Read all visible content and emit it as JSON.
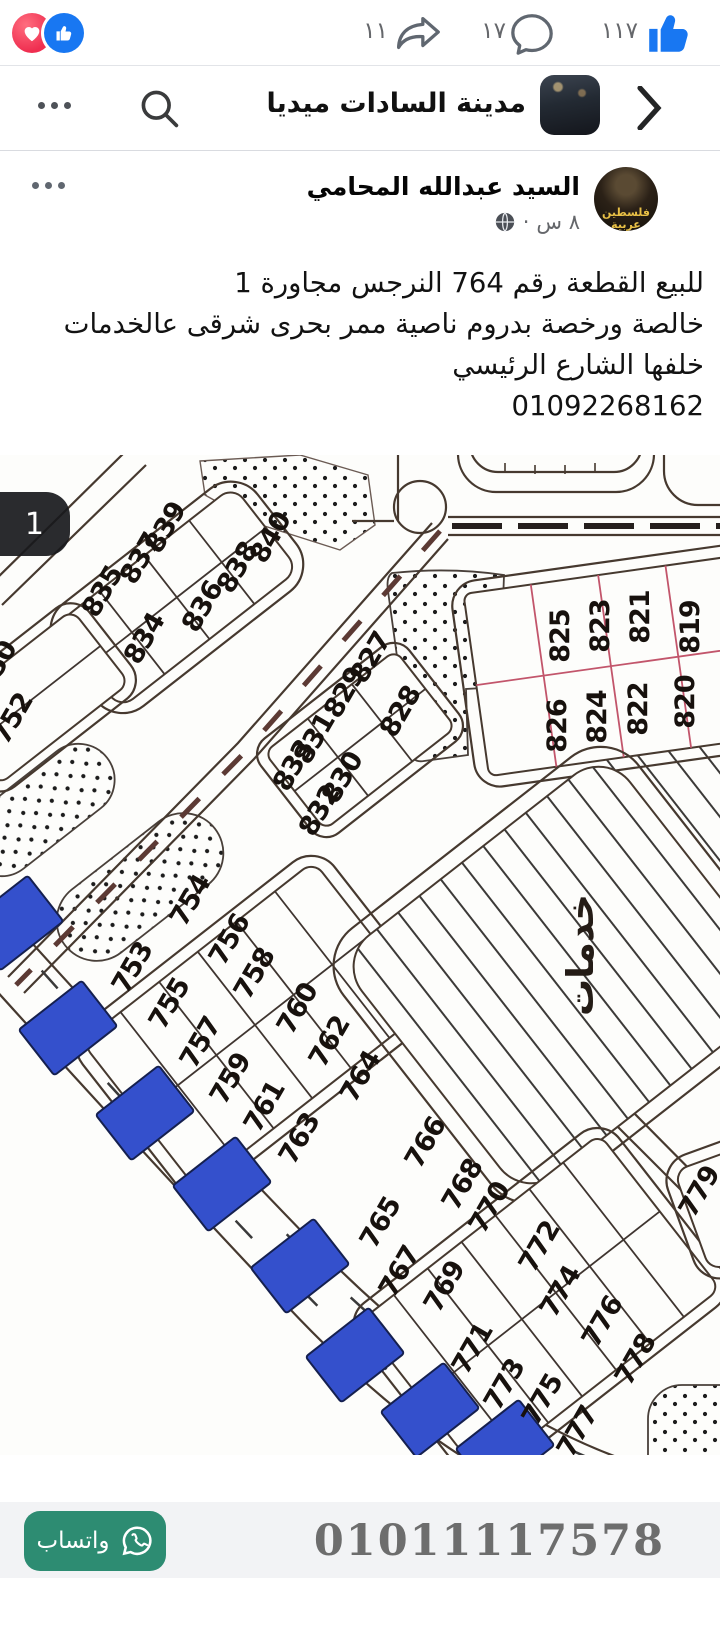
{
  "reactions_bar": {
    "share_count": "١١",
    "comment_count": "١٧",
    "like_count": "١١٧"
  },
  "header": {
    "title": "مدينة السادات ميديا"
  },
  "post": {
    "author": "السيد عبدالله المحامي",
    "avatar_text_line1": "فلسطين",
    "avatar_text_line2": "عربية",
    "time": "٨ س",
    "dot": "·",
    "body_lines": [
      "للبيع القطعة رقم 764 النرجس مجاورة 1",
      "خالصة ورخصة بدروم ناصية ممر بحرى شرقى عالخدمات",
      "خلفها الشارع الرئيسي",
      "01092268162"
    ]
  },
  "photo": {
    "counter": "1",
    "services_label": "خدمات",
    "highlight_color": "#3450cc",
    "plot_labels": [
      {
        "t": "750",
        "x": 4,
        "y": 216,
        "r": -60
      },
      {
        "t": "752",
        "x": 20,
        "y": 268,
        "r": -60
      },
      {
        "t": "835",
        "x": 110,
        "y": 141,
        "r": -60
      },
      {
        "t": "837",
        "x": 148,
        "y": 108,
        "r": -60
      },
      {
        "t": "839",
        "x": 173,
        "y": 77,
        "r": -60
      },
      {
        "t": "834",
        "x": 152,
        "y": 188,
        "r": -60
      },
      {
        "t": "836",
        "x": 210,
        "y": 156,
        "r": -60
      },
      {
        "t": "838",
        "x": 245,
        "y": 117,
        "r": -60
      },
      {
        "t": "840",
        "x": 278,
        "y": 87,
        "r": -60
      },
      {
        "t": "825",
        "x": 569,
        "y": 181,
        "r": -90
      },
      {
        "t": "823",
        "x": 609,
        "y": 171,
        "r": -90
      },
      {
        "t": "821",
        "x": 649,
        "y": 162,
        "r": -90
      },
      {
        "t": "819",
        "x": 699,
        "y": 172,
        "r": -90
      },
      {
        "t": "826",
        "x": 566,
        "y": 271,
        "r": -90
      },
      {
        "t": "824",
        "x": 606,
        "y": 262,
        "r": -90
      },
      {
        "t": "822",
        "x": 647,
        "y": 254,
        "r": -90
      },
      {
        "t": "820",
        "x": 694,
        "y": 247,
        "r": -90
      },
      {
        "t": "827",
        "x": 378,
        "y": 207,
        "r": -60
      },
      {
        "t": "829",
        "x": 352,
        "y": 242,
        "r": -60
      },
      {
        "t": "828",
        "x": 408,
        "y": 261,
        "r": -60
      },
      {
        "t": "831",
        "x": 322,
        "y": 288,
        "r": -60
      },
      {
        "t": "833",
        "x": 301,
        "y": 315,
        "r": -60
      },
      {
        "t": "830",
        "x": 350,
        "y": 327,
        "r": -60
      },
      {
        "t": "832",
        "x": 327,
        "y": 360,
        "r": -60
      },
      {
        "t": "753",
        "x": 140,
        "y": 517,
        "r": -60
      },
      {
        "t": "754",
        "x": 198,
        "y": 450,
        "r": -60
      },
      {
        "t": "755",
        "x": 177,
        "y": 553,
        "r": -60
      },
      {
        "t": "756",
        "x": 237,
        "y": 489,
        "r": -60
      },
      {
        "t": "757",
        "x": 208,
        "y": 592,
        "r": -60
      },
      {
        "t": "758",
        "x": 262,
        "y": 523,
        "r": -60
      },
      {
        "t": "759",
        "x": 238,
        "y": 628,
        "r": -60
      },
      {
        "t": "760",
        "x": 305,
        "y": 558,
        "r": -60
      },
      {
        "t": "761",
        "x": 272,
        "y": 656,
        "r": -60
      },
      {
        "t": "762",
        "x": 337,
        "y": 591,
        "r": -60
      },
      {
        "t": "763",
        "x": 307,
        "y": 688,
        "r": -60
      },
      {
        "t": "764",
        "x": 368,
        "y": 626,
        "r": -60
      },
      {
        "t": "765",
        "x": 388,
        "y": 772,
        "r": -60
      },
      {
        "t": "766",
        "x": 433,
        "y": 692,
        "r": -60
      },
      {
        "t": "767",
        "x": 407,
        "y": 821,
        "r": -60
      },
      {
        "t": "768",
        "x": 470,
        "y": 734,
        "r": -60
      },
      {
        "t": "769",
        "x": 452,
        "y": 836,
        "r": -60
      },
      {
        "t": "770",
        "x": 497,
        "y": 757,
        "r": -60
      },
      {
        "t": "771",
        "x": 480,
        "y": 898,
        "r": -60
      },
      {
        "t": "772",
        "x": 547,
        "y": 796,
        "r": -60
      },
      {
        "t": "773",
        "x": 512,
        "y": 934,
        "r": -60
      },
      {
        "t": "774",
        "x": 568,
        "y": 841,
        "r": -60
      },
      {
        "t": "775",
        "x": 550,
        "y": 949,
        "r": -60
      },
      {
        "t": "776",
        "x": 610,
        "y": 871,
        "r": -60
      },
      {
        "t": "777",
        "x": 585,
        "y": 981,
        "r": -60
      },
      {
        "t": "778",
        "x": 643,
        "y": 909,
        "r": -60
      },
      {
        "t": "779",
        "x": 707,
        "y": 741,
        "r": -60
      }
    ],
    "blue_plots": [
      {
        "x": 14,
        "y": 468
      },
      {
        "x": 68,
        "y": 573
      },
      {
        "x": 145,
        "y": 658
      },
      {
        "x": 222,
        "y": 729
      },
      {
        "x": 300,
        "y": 811
      },
      {
        "x": 355,
        "y": 900
      },
      {
        "x": 430,
        "y": 955
      },
      {
        "x": 505,
        "y": 992
      }
    ]
  },
  "cta": {
    "phone": "01011117578",
    "whatsapp_label": "واتساب"
  }
}
